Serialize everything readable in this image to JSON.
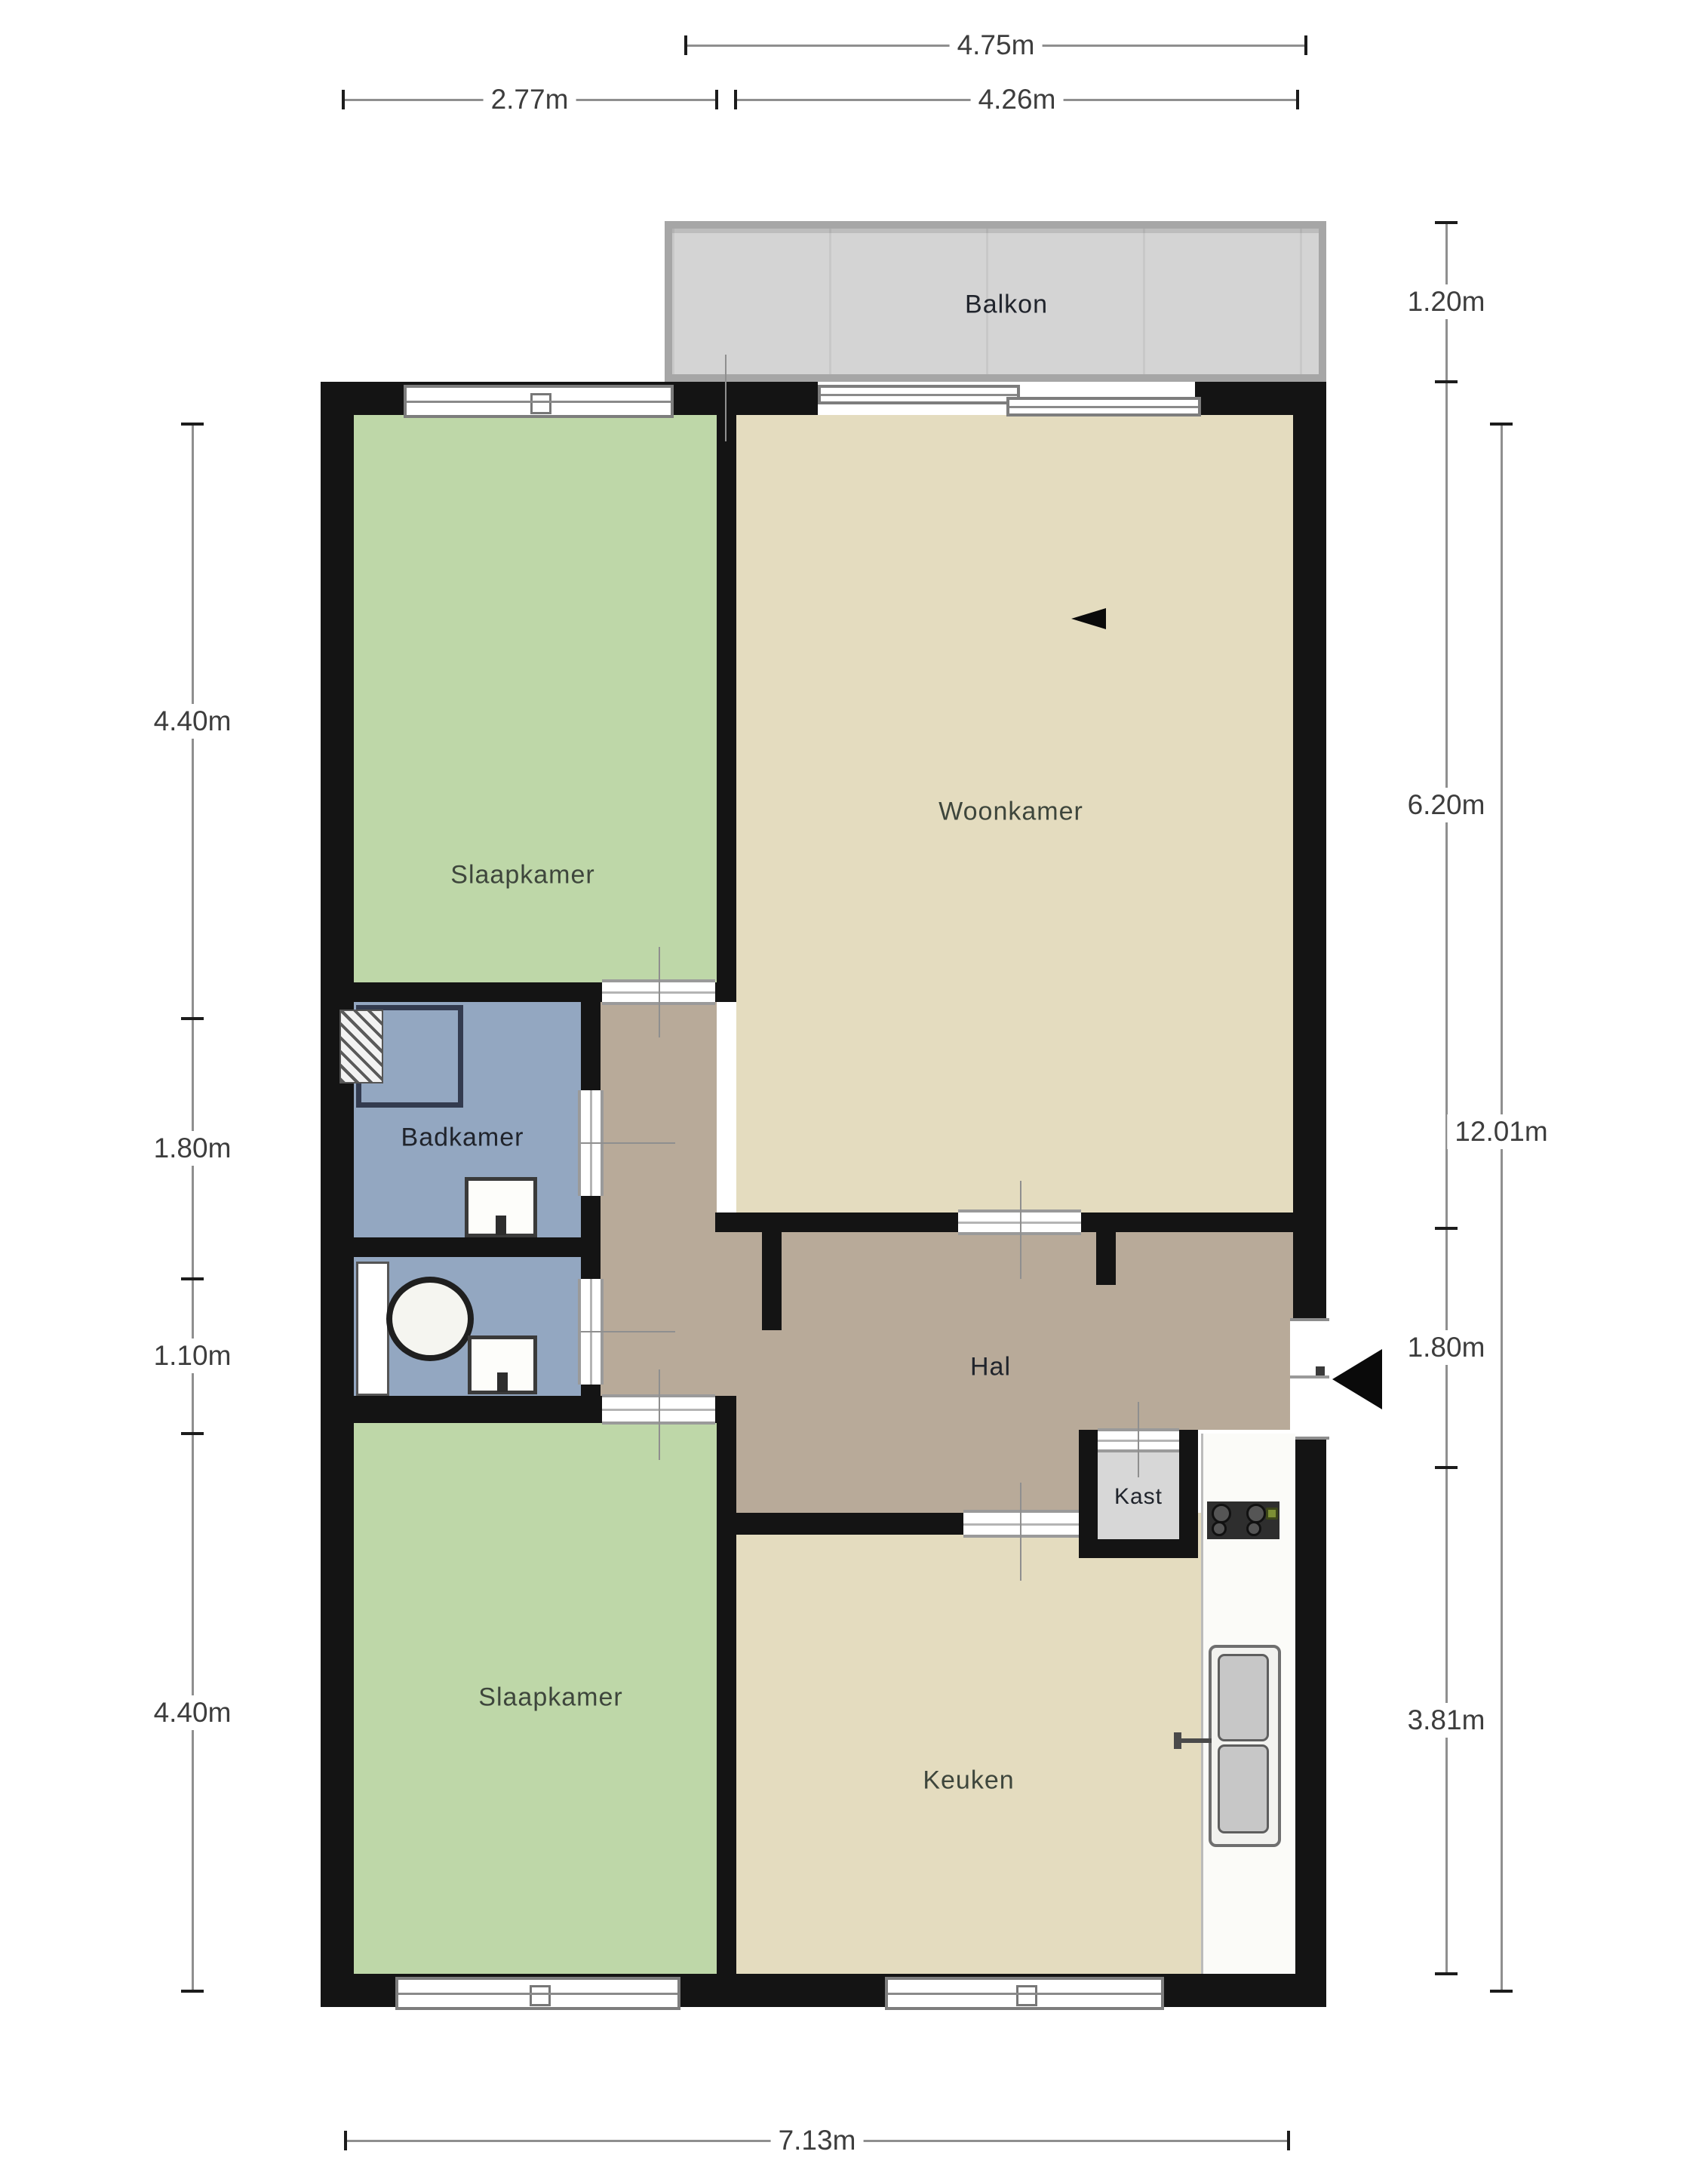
{
  "title": "Floor plan (plattegrond appartement)",
  "rooms": {
    "balkon": {
      "label": "Balkon"
    },
    "bedroom_top": {
      "label": "Slaapkamer"
    },
    "woonkamer": {
      "label": "Woonkamer"
    },
    "badkamer": {
      "label": "Badkamer"
    },
    "hal": {
      "label": "Hal"
    },
    "kast": {
      "label": "Kast"
    },
    "bedroom_bottom": {
      "label": "Slaapkamer"
    },
    "keuken": {
      "label": "Keuken"
    }
  },
  "dimensions": {
    "top_main": "4.75m",
    "top_left": "2.77m",
    "top_right": "4.26m",
    "left": [
      "4.40m",
      "1.80m",
      "1.10m",
      "4.40m"
    ],
    "right": [
      "1.20m",
      "6.20m",
      "1.80m",
      "3.81m"
    ],
    "right_total": "12.01m",
    "bottom": "7.13m"
  },
  "fixtures": [
    "shower",
    "radiator",
    "bath-sink",
    "toilet",
    "wc-sink",
    "wc-door-leaf",
    "stove",
    "kitchen-counter",
    "kitchen-sink",
    "entry-door",
    "entry-arrow",
    "balcony-sliding-door",
    "windows"
  ],
  "colors": {
    "wall": "#141414",
    "bedroom_fill": "#bed7a8",
    "living_fill": "#e4dcbf",
    "hall_fill": "#b8aa99",
    "bath_fill": "#93a7c1",
    "balcony_fill": "#d4d4d4",
    "balcony_rail": "#a6a6a6",
    "kast_fill": "#d7d7d7",
    "counter_fill": "#fbfbf8",
    "dimension_line": "#8f8f8f",
    "label_text": "#3e463c"
  }
}
